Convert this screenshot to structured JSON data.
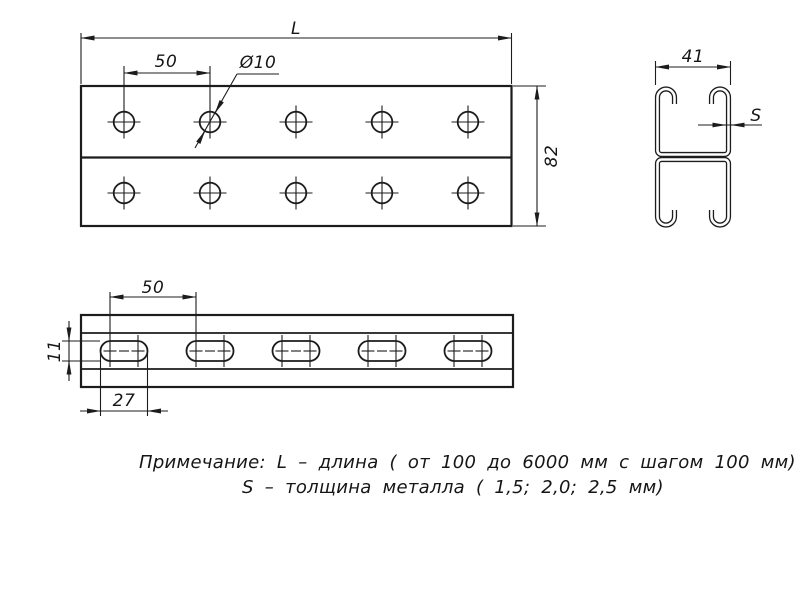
{
  "drawing": {
    "labels": {
      "length": "L",
      "hole_pitch": "50",
      "hole_diameter": "Ø10",
      "profile_height": "82",
      "profile_width": "41",
      "thickness": "S",
      "slot_pitch": "50",
      "slot_length": "27",
      "slot_width": "11"
    },
    "note": {
      "line1": "Примечание: L – длина ( от 100 до 6000 мм с шагом 100 мм)",
      "line2": "S – толщина металла ( 1,5; 2,0; 2,5 мм)"
    },
    "colors": {
      "line": "#1c1c1c",
      "background": "#ffffff"
    }
  }
}
